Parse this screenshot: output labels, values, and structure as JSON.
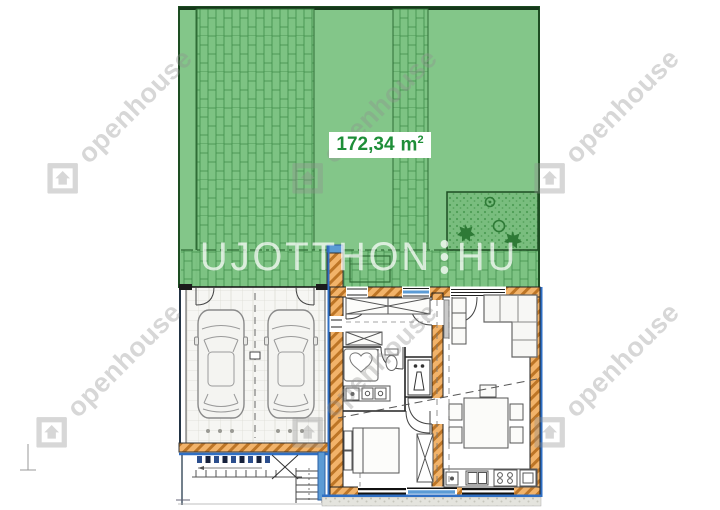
{
  "plan": {
    "area_label": {
      "value": "172,34",
      "unit": "m",
      "exponent": "2"
    }
  },
  "watermarks": {
    "brand_corner": "openhouse",
    "center_left": "UJOTTHON",
    "center_right": "HU"
  },
  "colors": {
    "garden_green": "#7dc383",
    "paving_joint_green": "#3e8d49",
    "garden_border": "#1d4d22",
    "wall_fill": "#f2b36a",
    "wall_hatch": "#bd7526",
    "insulation_blue": "#2f6fc4",
    "glazing_blue": "#5b9bd5",
    "area_label_text": "#1e8e38",
    "watermark_gray": "#d8d8d8",
    "drawing_line": "#333333",
    "gravel_gray": "#e4e4de"
  }
}
